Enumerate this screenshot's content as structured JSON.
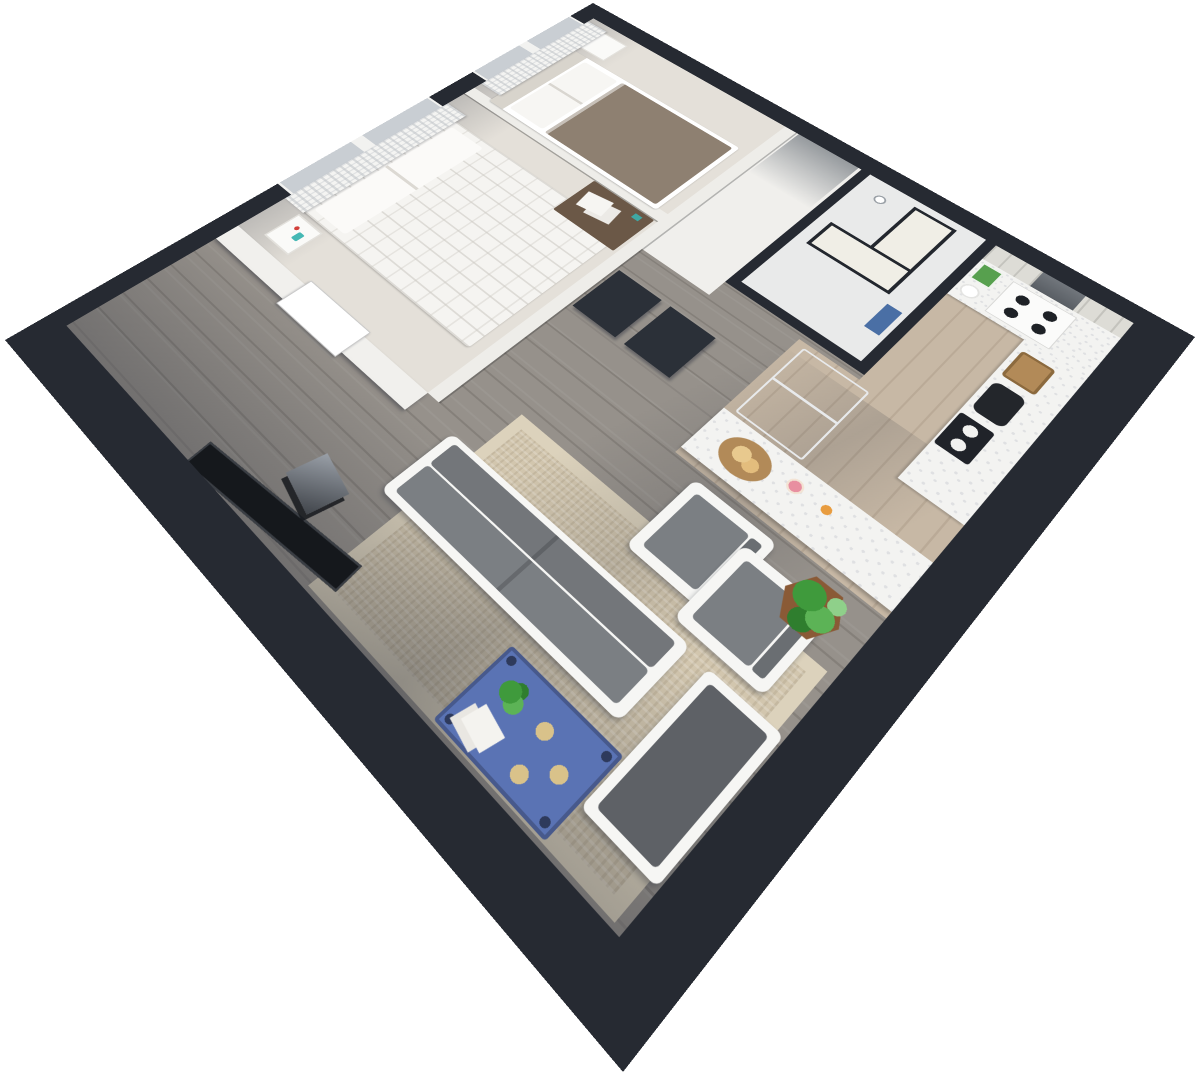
{
  "scene": {
    "type": "3d-isometric-floor-plan-render",
    "orientation": "square apartment rotated 45 degrees, viewed from above",
    "background": "#ffffff"
  },
  "palette": {
    "exterior_wall": "#262a32",
    "interior_wall": "#eeede9",
    "bedroom_floor": "#e4e0d9",
    "hall_floor": "#f0efec",
    "bath_floor": "#e9eaea",
    "kitchen_floor": "#c7b8a5",
    "living_floor": "#96918b",
    "rug": "#d2c6ae",
    "rug_border": "#dcd2bc",
    "sofa_frame": "#f6f6f4",
    "sofa_cushion": "#7b7f83",
    "seat_cushion": "#5e6166",
    "table_accent": "#5a73b4",
    "table_edge": "#47598c",
    "coaster_gold": "#d9c28a",
    "plant_green": "#3f9a3c",
    "planter_brown": "#8a5a36",
    "curtain_white": "#f4f4f2",
    "glass_blue": "#c9ced3",
    "glass_cream": "#f0eee6",
    "bed_blanket": "#8e8071",
    "duvet_white": "#f5f4f1",
    "headboard": "#d8d4cc",
    "counter_white": "#f3f3f1",
    "plank_wall": "#dddcd6",
    "fridge_gray": "#9aa3ad",
    "desk_wood": "#6b5847",
    "vase_teal": "#45b8b4",
    "tv_black": "#15181c",
    "shower_blue": "#4a6fa5",
    "basket_tan": "#b28a58",
    "kettle_black": "#23262b",
    "cereal_green": "#57a04e",
    "cupcake_pink": "#e88fa0",
    "orange_fruit": "#e89c3f",
    "door_dark": "#2b3038"
  },
  "rooms": [
    {
      "id": "bedroom-2",
      "label": "Bedroom 2",
      "furniture": [
        "window with sheer lace curtains",
        "bed with white pillows and tan blanket",
        "white nightstand"
      ]
    },
    {
      "id": "bedroom-1",
      "label": "Bedroom 1",
      "furniture": [
        "window with sheer lace curtains",
        "double bed with white quilted duvet",
        "nightstand with red flower and teal vase",
        "dark wood desk with papers"
      ]
    },
    {
      "id": "hallway",
      "label": "Entry Hall",
      "furniture": [
        "entry doorway",
        "two dark closet door panels"
      ]
    },
    {
      "id": "bathroom",
      "label": "Bathroom",
      "furniture": [
        "glass shower enclosure with dark frame",
        "shower head",
        "blue bath mat"
      ]
    },
    {
      "id": "kitchen",
      "label": "Kitchen",
      "furniture": [
        "stainless refrigerator",
        "four-burner cooktop",
        "white speckled counters",
        "whitewashed plank backsplash",
        "dark window panel",
        "green cereal box",
        "stacked white plates",
        "wicker basket",
        "black kettle",
        "two-burner portable stove",
        "bread bowl",
        "pink cupcake",
        "orange"
      ]
    },
    {
      "id": "living-room",
      "label": "Living Room",
      "furniture": [
        "white-frame sofa with gray cushions",
        "two white-frame armchairs",
        "blue coffee table with plant, books and gold coasters",
        "beige woven area rug",
        "colorful floral wall art",
        "wall-mounted tv",
        "gray media stand",
        "white-frame bench seat with dark cushion",
        "potted plant in hexagonal planter"
      ]
    }
  ]
}
